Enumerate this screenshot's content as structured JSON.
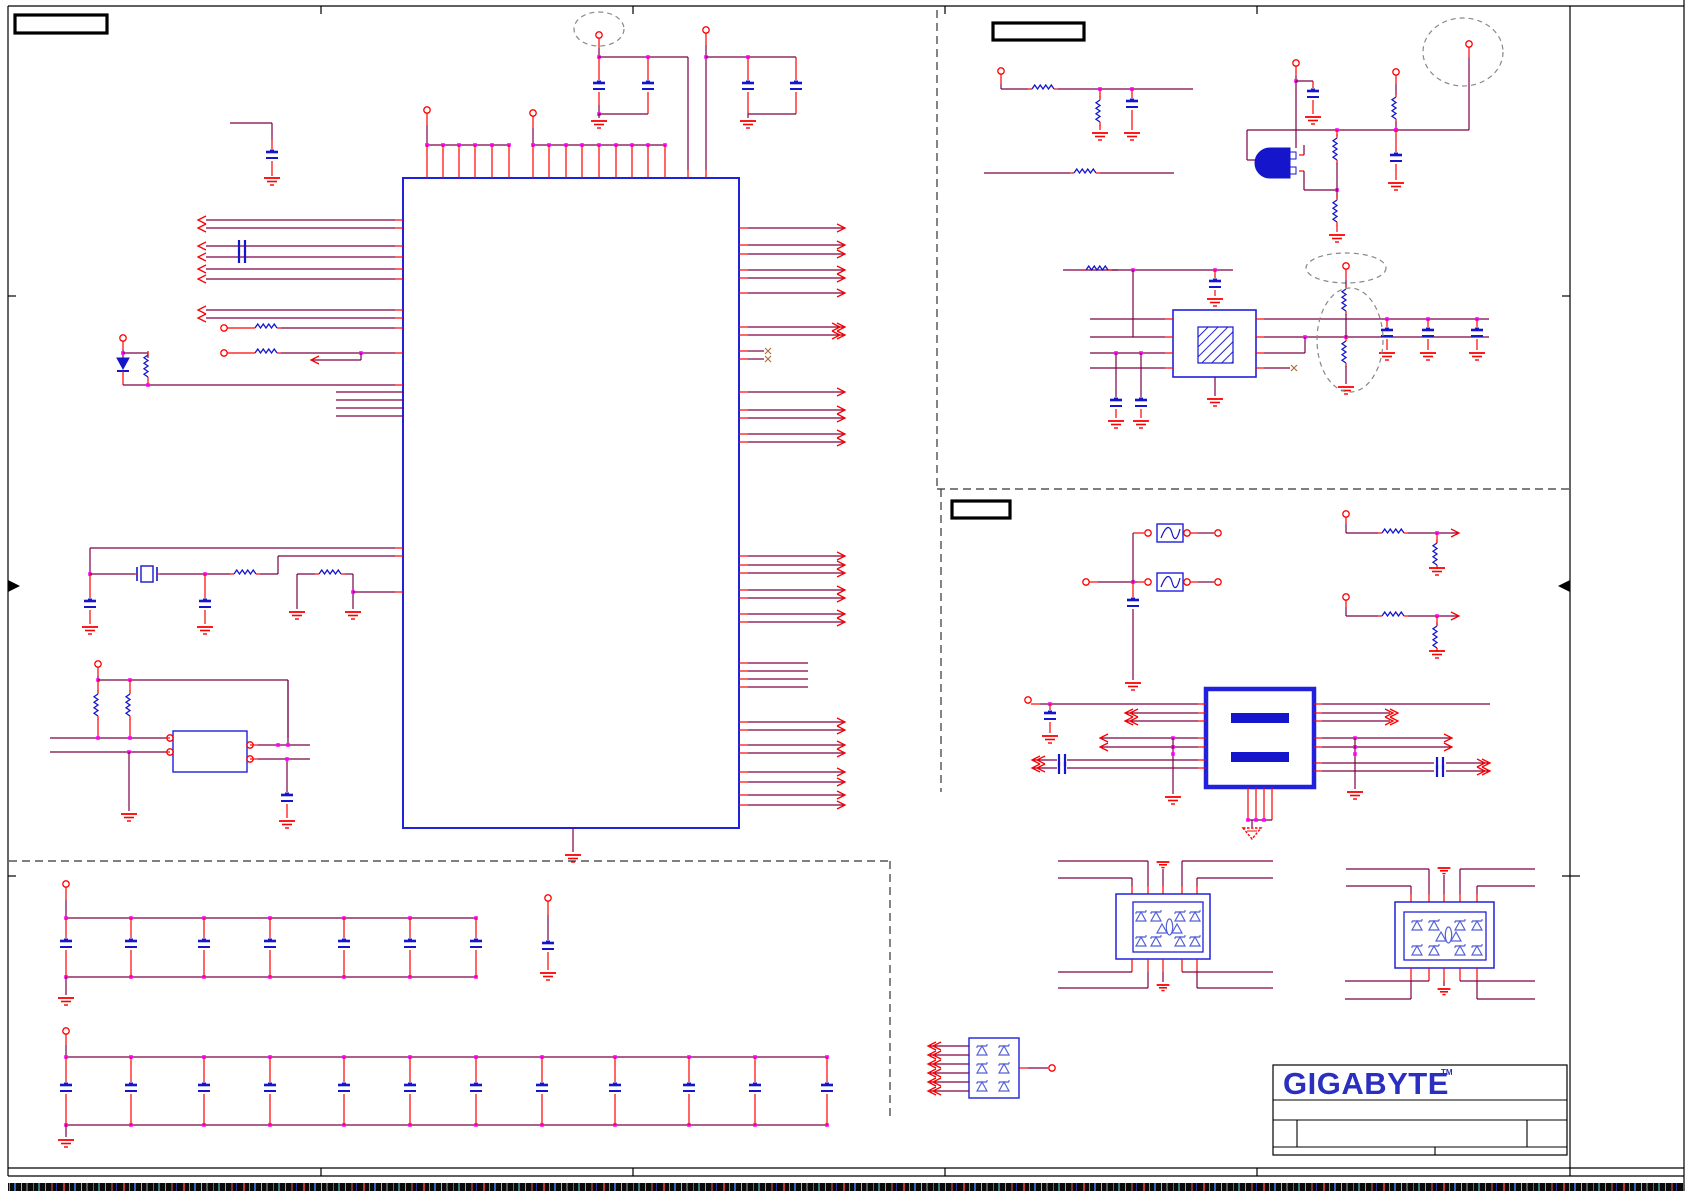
{
  "sheet": {
    "type": "circuit-schematic-page",
    "visible_text_note": "schematic net/reference text layer is not rendered in this capture",
    "label_boxes": [
      {
        "id": "label-box-top-left",
        "text": ""
      },
      {
        "id": "label-box-top-right",
        "text": ""
      },
      {
        "id": "label-box-lan",
        "text": ""
      }
    ]
  },
  "title_block": {
    "brand": "GIGABYTE",
    "trademark": "TM",
    "fields": {
      "title": "",
      "size": "",
      "document_number": "",
      "rev": "",
      "date": "",
      "sheet": ""
    }
  },
  "colors": {
    "wire": "#7a0045",
    "pin_red": "#ff0000",
    "component_blue": "#1515cc",
    "ic_border_blue": "#2020dd",
    "diode_blue": "#5560d8",
    "junction_magenta": "#ff00ff",
    "frame_black": "#000000",
    "dashed_divider": "#333333",
    "dashed_annotation": "#888888",
    "logo_blue": "#2b2fc0"
  },
  "components": {
    "main_ic": {
      "shape": "large-rectangle",
      "left_pins": 14,
      "right_pins": 33,
      "top_pins": 17,
      "bottom_pins": 1
    },
    "crystal_oscillator_module": 1,
    "crystal": 1,
    "lan_transformer": 1,
    "fuses": 2,
    "transistor": 1,
    "protection_diode_arrays": 3,
    "decoupling_cap_bank_row1": 7,
    "decoupling_cap_bank_row2": 12,
    "dashed_highlight_ellipses": 4
  },
  "icons": [
    "ground-icon",
    "chassis-ground-icon",
    "capacitor-icon",
    "resistor-icon",
    "pin-circle-icon",
    "junction-dot-icon",
    "net-arrow-icon",
    "diode-icon",
    "transformer-icon",
    "fuse-icon",
    "crystal-icon",
    "hatch-osc-icon"
  ]
}
